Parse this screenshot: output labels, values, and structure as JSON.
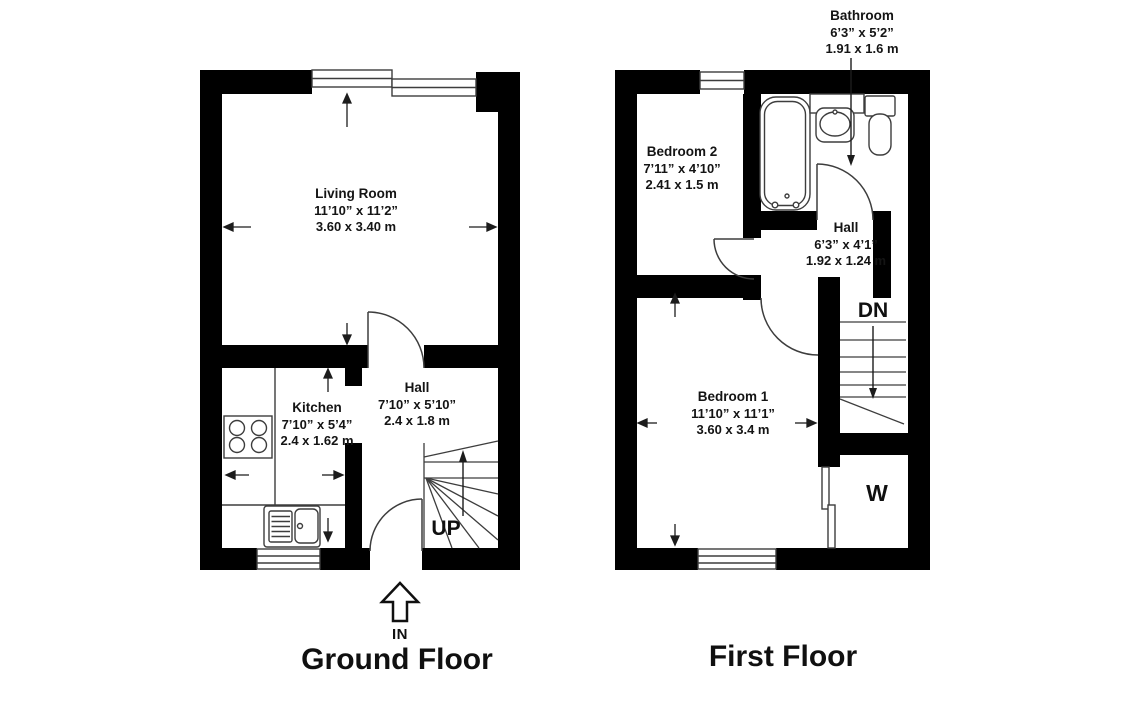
{
  "colors": {
    "wall": "#000000",
    "fixture_line": "#3d3d3d",
    "arrow": "#1c1c1c",
    "text": "#141414",
    "background": "#ffffff"
  },
  "ground_floor": {
    "title": "Ground Floor",
    "entrance": "IN",
    "stairs": "UP",
    "rooms": {
      "living_room": {
        "name": "Living Room",
        "imperial": "11’10” x 11’2”",
        "metric": "3.60 x 3.40 m"
      },
      "kitchen": {
        "name": "Kitchen",
        "imperial": "7’10” x 5’4”",
        "metric": "2.4 x 1.62 m"
      },
      "hall": {
        "name": "Hall",
        "imperial": "7’10” x 5’10”",
        "metric": "2.4 x 1.8 m"
      }
    }
  },
  "first_floor": {
    "title": "First Floor",
    "stairs": "DN",
    "wardrobe": "W",
    "rooms": {
      "bedroom_2": {
        "name": "Bedroom 2",
        "imperial": "7’11” x 4’10”",
        "metric": "2.41 x 1.5 m"
      },
      "bathroom": {
        "name": "Bathroom",
        "imperial": "6’3” x 5’2”",
        "metric": "1.91 x 1.6 m"
      },
      "hall": {
        "name": "Hall",
        "imperial": "6’3” x 4’1”",
        "metric": "1.92 x 1.24 m"
      },
      "bedroom_1": {
        "name": "Bedroom 1",
        "imperial": "11’10” x 11’1”",
        "metric": "3.60 x 3.4 m"
      }
    }
  }
}
